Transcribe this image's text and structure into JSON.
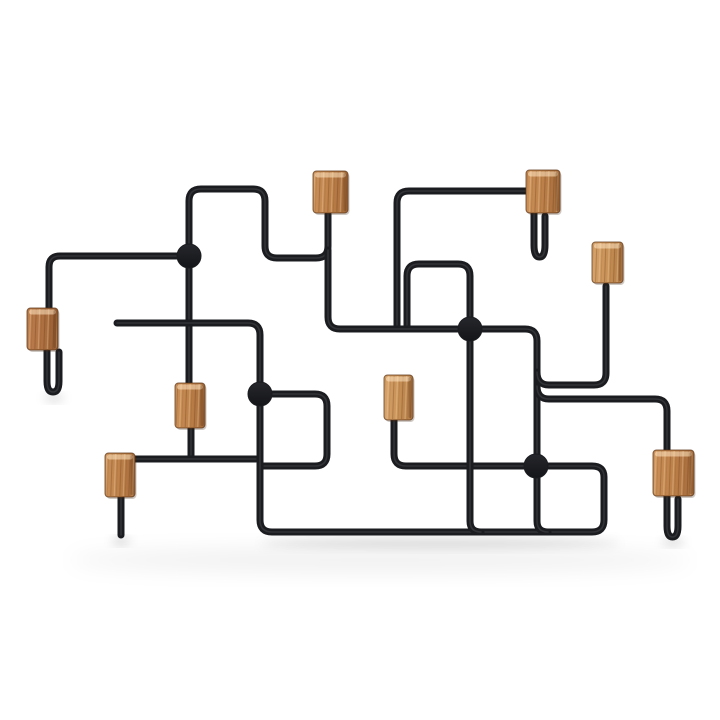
{
  "meta": {
    "description": "Product photo of a wall-mounted coat rack: a maze-like frame of bent black metal wire with eight rectangular oak wood peg blocks and four round weld dots, on a plain white background with a soft floor shadow.",
    "background_color": "#ffffff",
    "wire_color": "#1b1c20",
    "wire_width": 7,
    "wood_tones": {
      "t1_light": [
        "#d4a univers06b",
        "#c28b52"
      ],
      "t2_mid": [
        "#c68d58",
        "#ad7243"
      ],
      "t3_dark": [
        "#b97c4e",
        "#9c6238"
      ]
    }
  },
  "scene": {
    "shadows": [
      {
        "name": "rail-shadow",
        "cx": 440,
        "cy": 543,
        "rx": 180,
        "ry": 5,
        "opacity": 0.13
      },
      {
        "name": "floor-haze",
        "cx": 380,
        "cy": 560,
        "rx": 310,
        "ry": 12,
        "opacity": 0.06
      },
      {
        "name": "left-hook-tip-shadow",
        "cx": 54,
        "cy": 398,
        "rx": 10,
        "ry": 3,
        "opacity": 0.18
      },
      {
        "name": "peg-spike-tip-shadow",
        "cx": 121,
        "cy": 541,
        "rx": 9,
        "ry": 3,
        "opacity": 0.2
      },
      {
        "name": "right-hook-tip-shadow",
        "cx": 673,
        "cy": 542,
        "rx": 11,
        "ry": 3,
        "opacity": 0.18
      }
    ],
    "wires": [
      {
        "name": "wire-left-rail-over-bridge",
        "d": "M 49 316 V 267 Q 49 256 60 256 H 189 V 201 Q 189 189 201 189 H 253 Q 265 189 265 201 V 246 Q 265 258 277 258 H 316 Q 328 258 328 246 V 214"
      },
      {
        "name": "wire-left-block-hook",
        "d": "M 47 332 V 381 Q 47 392 53 392 Q 59 392 59 381 V 352"
      },
      {
        "name": "wire-dotA-down-to-midleft-block",
        "d": "M 189 256 V 387"
      },
      {
        "name": "wire-midleft-block-lower-stem",
        "d": "M 191 424 V 457"
      },
      {
        "name": "wire-rail-into-lowerleft-block",
        "d": "M 131 459 H 256"
      },
      {
        "name": "wire-dotC-zigzag",
        "d": "M 260 394 H 315 Q 327 394 327 406 V 454 Q 327 466 315 466 H 262"
      },
      {
        "name": "wire-long-bent-rail",
        "d": "M 117 323 H 248 Q 260 323 260 335 V 520 Q 260 532 272 532 H 592 Q 604 532 604 520 V 477 Q 604 466 592 466 H 546"
      },
      {
        "name": "wire-dotD-left-to-center-block",
        "d": "M 536 466 H 406 Q 394 466 394 454 V 419"
      },
      {
        "name": "wire-dotD-down-corner",
        "d": "M 537 462 V 521 Q 537 532 548 532"
      },
      {
        "name": "wire-dotB-down-corner",
        "d": "M 470 333 V 521 Q 470 532 481 532"
      },
      {
        "name": "wire-dotB-up-square",
        "d": "M 470 333 V 276 Q 470 264 458 264 H 419 Q 407 264 407 276 V 326"
      },
      {
        "name": "wire-tall-rect-to-topcenter-block",
        "d": "M 397 326 V 203 Q 397 191 409 191 H 528"
      },
      {
        "name": "wire-topcenter-block-hook",
        "d": "M 534 205 V 245 Q 534 257 539.5 257 Q 545 257 545 245 V 216"
      },
      {
        "name": "wire-cross-link-below-topleft-block",
        "d": "M 328 250 V 317 Q 328 329 340 329 H 465"
      },
      {
        "name": "wire-dotB-right-down-to-dotD",
        "d": "M 474 329 H 525 Q 537 329 537 341 V 459"
      },
      {
        "name": "wire-branch-up-to-rightupper-block",
        "d": "M 537 372 Q 537 385 549 385 H 594 Q 606 385 606 373 V 286"
      },
      {
        "name": "wire-branch-to-rightlower-block",
        "d": "M 537 386 Q 537 399 549 399 H 655 Q 667 399 667 411 V 453"
      },
      {
        "name": "wire-rightlower-block-hook",
        "d": "M 667 482 V 526 Q 667 537 672.5 537 Q 678 537 678 526 V 499"
      },
      {
        "name": "wire-lowerleft-block-spike",
        "d": "M 121 494 V 535"
      }
    ],
    "dots": [
      {
        "name": "weld-dot-A",
        "cx": 189,
        "cy": 256,
        "r": 12
      },
      {
        "name": "weld-dot-B",
        "cx": 470,
        "cy": 329,
        "r": 12
      },
      {
        "name": "weld-dot-C",
        "cx": 260,
        "cy": 394,
        "r": 12
      },
      {
        "name": "weld-dot-D",
        "cx": 536,
        "cy": 466,
        "r": 12
      }
    ],
    "blocks": [
      {
        "name": "wood-block-top-left",
        "x": 313,
        "y": 171,
        "w": 35,
        "h": 42,
        "tone": "t2"
      },
      {
        "name": "wood-block-top-center",
        "x": 526,
        "y": 170,
        "w": 34,
        "h": 43,
        "tone": "t2"
      },
      {
        "name": "wood-block-right-upper",
        "x": 592,
        "y": 242,
        "w": 31,
        "h": 41,
        "tone": "t1"
      },
      {
        "name": "wood-block-left",
        "x": 27,
        "y": 308,
        "w": 31,
        "h": 42,
        "tone": "t3"
      },
      {
        "name": "wood-block-mid-left",
        "x": 175,
        "y": 383,
        "w": 30,
        "h": 45,
        "tone": "t2"
      },
      {
        "name": "wood-block-center",
        "x": 384,
        "y": 375,
        "w": 29,
        "h": 45,
        "tone": "t1"
      },
      {
        "name": "wood-block-lower-left",
        "x": 105,
        "y": 453,
        "w": 30,
        "h": 44,
        "tone": "t2"
      },
      {
        "name": "wood-block-right-lower",
        "x": 653,
        "y": 450,
        "w": 41,
        "h": 46,
        "tone": "t2"
      }
    ]
  }
}
